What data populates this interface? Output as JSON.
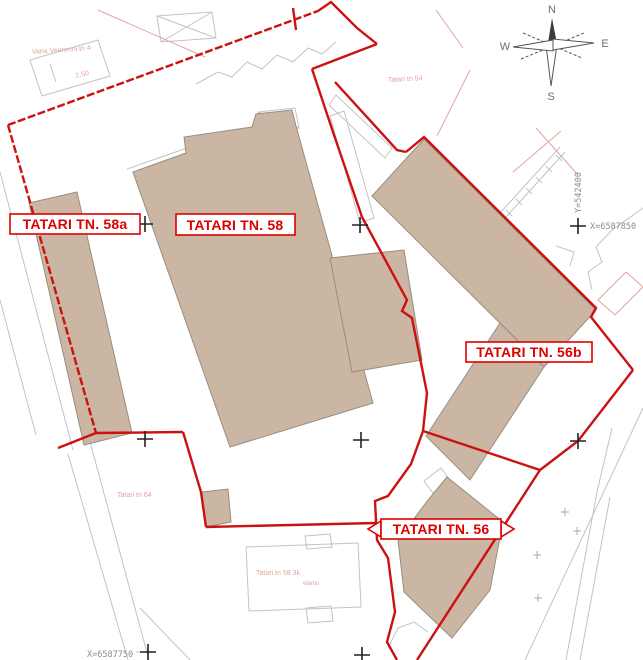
{
  "map": {
    "parcel_labels": {
      "tatari_58a": "TATARI TN. 58a",
      "tatari_58": "TATARI TN. 58",
      "tatari_56b": "TATARI TN. 56b",
      "tatari_56": "TATARI TN. 56"
    },
    "grid_coordinates": {
      "x_right": "X=6587850",
      "y_right": "Y=542400",
      "x_bottom": "X=6587750"
    },
    "background_labels": {
      "vana_veerenni_tn_4": "Vana Veerenni tn 4",
      "elevation": "2.50",
      "tatari_tn_54": "Tatari tn 54",
      "tatari_tn_64": "Tatari tn 64",
      "tatari_tn_58_3k": "Tatari tn 58 3k",
      "elamu": "elamu"
    },
    "compass": {
      "north": "N",
      "south": "S",
      "east": "E",
      "west": "W"
    },
    "colors": {
      "boundary_red": "#cc1111",
      "label_red": "#dd0000",
      "building_fill": "#cab6a3",
      "building_stroke": "#998d80",
      "faint_gray": "#c3c3c3",
      "faint_pink": "#e2a49f",
      "coordinate_gray": "#8b8b8b",
      "grid_cross_black": "#222222"
    }
  }
}
